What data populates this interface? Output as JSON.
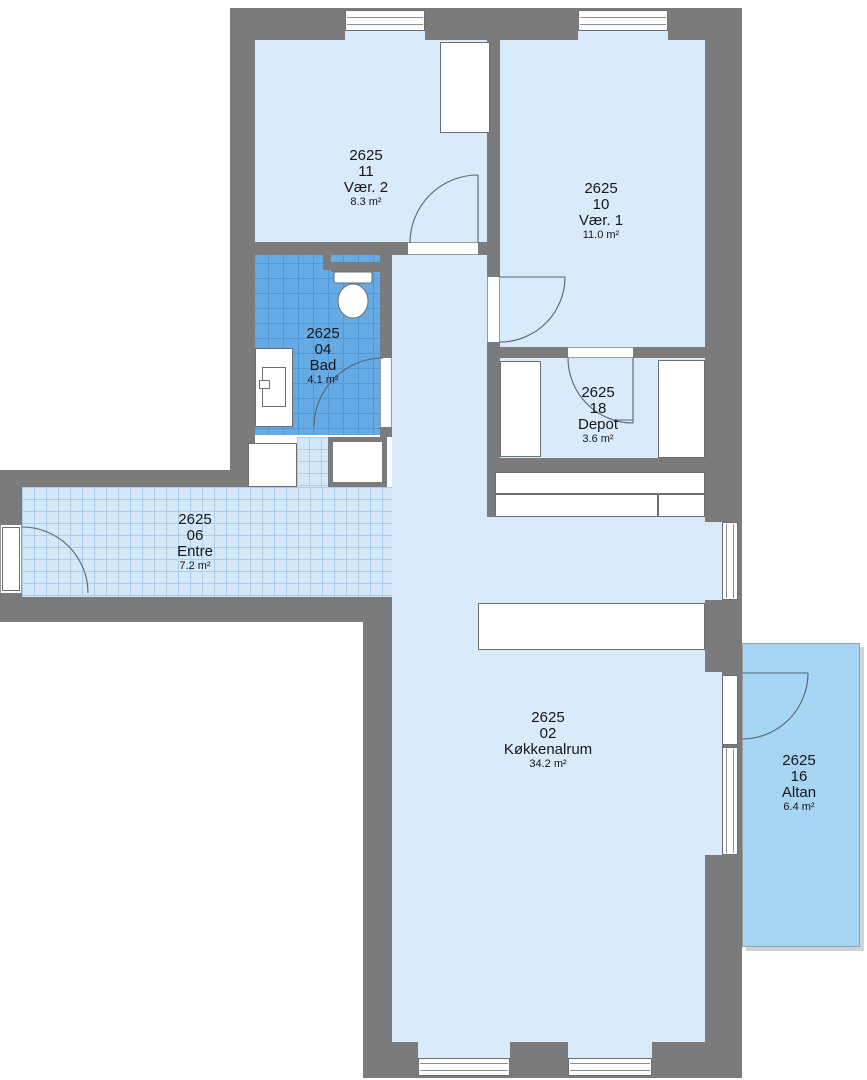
{
  "plan": {
    "building_code": "2625",
    "rooms": [
      {
        "code": "2625",
        "unit": "11",
        "name": "Vær. 2",
        "area": "8.3 m²"
      },
      {
        "code": "2625",
        "unit": "10",
        "name": "Vær. 1",
        "area": "11.0 m²"
      },
      {
        "code": "2625",
        "unit": "04",
        "name": "Bad",
        "area": "4.1 m²"
      },
      {
        "code": "2625",
        "unit": "18",
        "name": "Depot",
        "area": "3.6 m²"
      },
      {
        "code": "2625",
        "unit": "06",
        "name": "Entre",
        "area": "7.2 m²"
      },
      {
        "code": "2625",
        "unit": "02",
        "name": "Køkkenalrum",
        "area": "34.2 m²"
      },
      {
        "code": "2625",
        "unit": "16",
        "name": "Altan",
        "area": "6.4 m²"
      }
    ],
    "colors": {
      "wall": "#7b7b7b",
      "floor": "#d9eafb",
      "bad_tile": "#66abe5",
      "bad_tile_line": "#4e9ad8",
      "entre_tile": "#d5e8f8",
      "entre_tile_line": "#aecde9",
      "altan": "#a6d6f4",
      "fixture_border": "#6e6e6e",
      "arc": "#56656e"
    }
  }
}
